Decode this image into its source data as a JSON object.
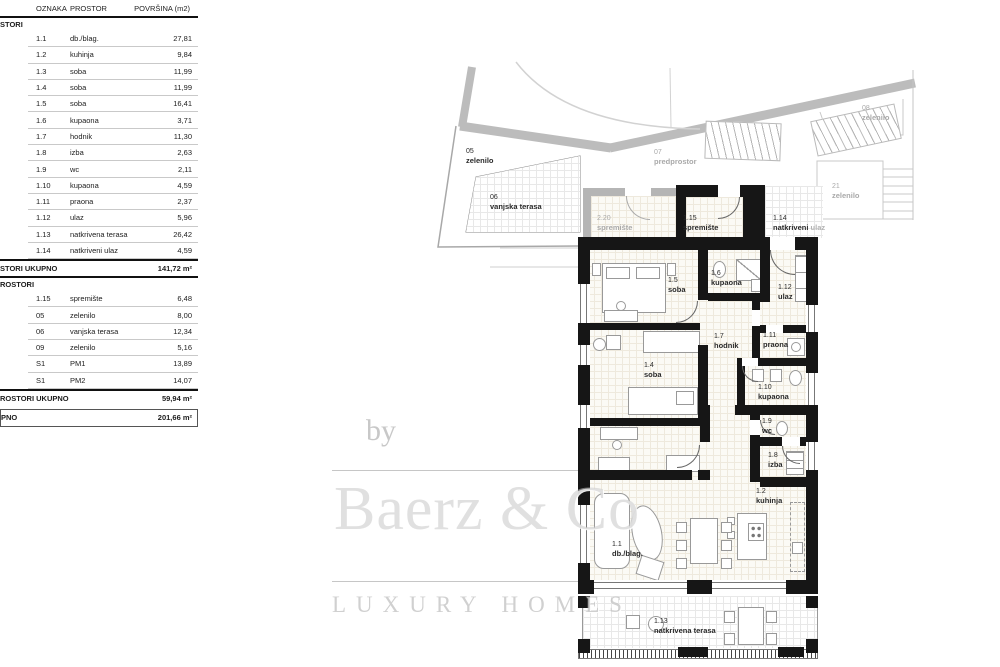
{
  "palette": {
    "wall": "#161616",
    "gray_band": "#bcbcbc",
    "gray_text": "#a9a9a9",
    "grid_line": "#eee9dd"
  },
  "table": {
    "headers": {
      "oznaka": "OZNAKA",
      "prostor": "PROSTOR",
      "povrsina": "POVRŠINA (m2)"
    },
    "section1": {
      "title": "STORI",
      "rows": [
        {
          "code": "1.1",
          "name": "db./blag.",
          "area": "27,81"
        },
        {
          "code": "1.2",
          "name": "kuhinja",
          "area": "9,84"
        },
        {
          "code": "1.3",
          "name": "soba",
          "area": "11,99"
        },
        {
          "code": "1.4",
          "name": "soba",
          "area": "11,99"
        },
        {
          "code": "1.5",
          "name": "soba",
          "area": "16,41"
        },
        {
          "code": "1.6",
          "name": "kupaona",
          "area": "3,71"
        },
        {
          "code": "1.7",
          "name": "hodnik",
          "area": "11,30"
        },
        {
          "code": "1.8",
          "name": "izba",
          "area": "2,63"
        },
        {
          "code": "1.9",
          "name": "wc",
          "area": "2,11"
        },
        {
          "code": "1.10",
          "name": "kupaona",
          "area": "4,59"
        },
        {
          "code": "1.11",
          "name": "praona",
          "area": "2,37"
        },
        {
          "code": "1.12",
          "name": "ulaz",
          "area": "5,96"
        },
        {
          "code": "1.13",
          "name": "natkrivena terasa",
          "area": "26,42"
        },
        {
          "code": "1.14",
          "name": "natkriveni ulaz",
          "area": "4,59"
        }
      ],
      "total_label": "STORI UKUPNO",
      "total_value": "141,72 m²"
    },
    "section2": {
      "title": "ROSTORI",
      "rows": [
        {
          "code": "1.15",
          "name": "spremište",
          "area": "6,48"
        },
        {
          "code": "05",
          "name": "zelenilo",
          "area": "8,00"
        },
        {
          "code": "06",
          "name": "vanjska terasa",
          "area": "12,34"
        },
        {
          "code": "09",
          "name": "zelenilo",
          "area": "5,16"
        },
        {
          "code": "S1",
          "name": "PM1",
          "area": "13,89"
        },
        {
          "code": "S1",
          "name": "PM2",
          "area": "14,07"
        }
      ],
      "total_label": "ROSTORI UKUPNO",
      "total_value": "59,94 m²"
    },
    "grand": {
      "label": "PNO",
      "value": "201,66 m²"
    }
  },
  "plan": {
    "labels": {
      "z05": {
        "code": "05",
        "name": "zelenilo"
      },
      "z06": {
        "code": "06",
        "name": "vanjska terasa"
      },
      "z07": {
        "code": "07",
        "name": "predprostor"
      },
      "z08": {
        "code": "08",
        "name": "zelenilo"
      },
      "z21": {
        "code": "21",
        "name": "zelenilo"
      },
      "s220": {
        "code": "2.20",
        "name": "spremište"
      },
      "s115": {
        "code": "1.15",
        "name": "spremište"
      },
      "s114": {
        "code": "1.14",
        "name_black": "natkriveni",
        "name_gray": "ulaz"
      },
      "r15": {
        "code": "1.5",
        "name": "soba"
      },
      "r16": {
        "code": "1.6",
        "name": "kupaona"
      },
      "r112": {
        "code": "1.12",
        "name": "ulaz"
      },
      "r17": {
        "code": "1.7",
        "name": "hodnik"
      },
      "r111": {
        "code": "1.11",
        "name": "praona"
      },
      "r14": {
        "code": "1.4",
        "name": "soba"
      },
      "r110": {
        "code": "1.10",
        "name": "kupaona"
      },
      "r19": {
        "code": "1.9",
        "name": "wc"
      },
      "r18": {
        "code": "1.8",
        "name": "izba"
      },
      "r12": {
        "code": "1.2",
        "name": "kuhinja"
      },
      "r11": {
        "code": "1.1",
        "name": "db./blag."
      },
      "r113": {
        "code": "1.13",
        "name": "natkrivena terasa"
      }
    }
  },
  "watermark": {
    "by": "by",
    "brand": "Baerz & Co",
    "tagline": "LUXURY HOMES"
  }
}
